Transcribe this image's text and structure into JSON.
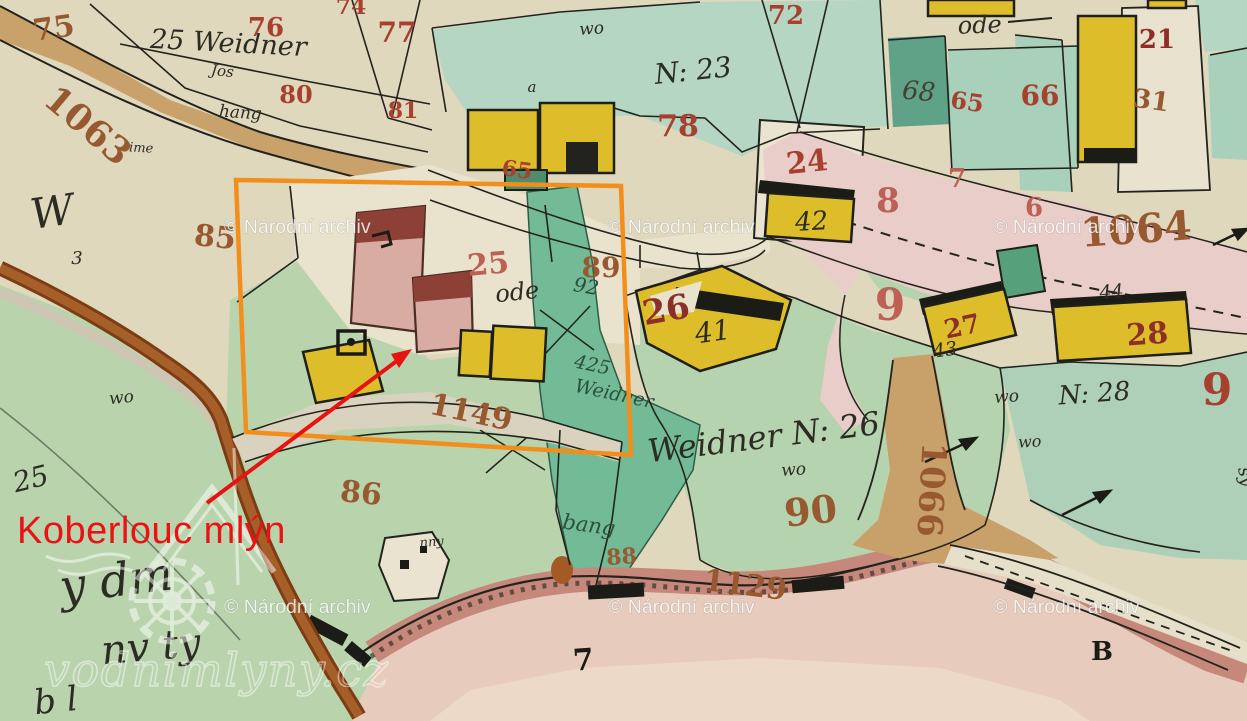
{
  "annotation": {
    "label": "Koberlouc mlýn",
    "label_color": "#ea1313",
    "arrow_color": "#e81212",
    "box_color": "#f28e1c"
  },
  "watermarks": {
    "archive_text": "© Národní archiv",
    "archive_color": "rgba(255,255,255,0.8)",
    "positions": [
      {
        "x": 224,
        "y": 233
      },
      {
        "x": 608,
        "y": 233
      },
      {
        "x": 993,
        "y": 233
      },
      {
        "x": 224,
        "y": 613
      },
      {
        "x": 608,
        "y": 613
      },
      {
        "x": 993,
        "y": 613
      }
    ],
    "site_text": "vodnimlyny.cz"
  },
  "palette": {
    "red": "#a8402f",
    "pinkRed": "#bd6055",
    "darkRed": "#8c2f28",
    "brown": "#975930",
    "teal": "#2d4f3e",
    "black": "#2c2c24",
    "dark": "#45402f",
    "blackBold": "#1c1c16"
  },
  "map_labels": {
    "items": [
      {
        "t": "75",
        "x": 55,
        "y": 38,
        "s": 30,
        "c": "brown",
        "r": -8,
        "f": "num"
      },
      {
        "t": "25 Weidner",
        "x": 228,
        "y": 52,
        "s": 27,
        "c": "black",
        "r": 3,
        "f": "script"
      },
      {
        "t": "Jos",
        "x": 222,
        "y": 76,
        "s": 15,
        "c": "black",
        "r": 6,
        "f": "script"
      },
      {
        "t": "hang",
        "x": 240,
        "y": 118,
        "s": 17,
        "c": "black",
        "r": 4,
        "f": "script"
      },
      {
        "t": "ime",
        "x": 141,
        "y": 152,
        "s": 13,
        "c": "black",
        "r": 3,
        "f": "script"
      },
      {
        "t": "1063",
        "x": 80,
        "y": 135,
        "s": 36,
        "c": "brown",
        "r": 40,
        "f": "num"
      },
      {
        "t": "76",
        "x": 266,
        "y": 36,
        "s": 26,
        "c": "red",
        "r": 0,
        "f": "num"
      },
      {
        "t": "74",
        "x": 351,
        "y": 14,
        "s": 22,
        "c": "red",
        "r": 0,
        "f": "num"
      },
      {
        "t": "77",
        "x": 397,
        "y": 42,
        "s": 28,
        "c": "red",
        "r": 0,
        "f": "num"
      },
      {
        "t": "80",
        "x": 296,
        "y": 103,
        "s": 24,
        "c": "red",
        "r": 0,
        "f": "num"
      },
      {
        "t": "81",
        "x": 403,
        "y": 118,
        "s": 22,
        "c": "red",
        "r": 0,
        "f": "num"
      },
      {
        "t": "wo",
        "x": 592,
        "y": 34,
        "s": 17,
        "c": "black",
        "r": -4,
        "f": "script"
      },
      {
        "t": "a",
        "x": 532,
        "y": 92,
        "s": 15,
        "c": "black",
        "r": 0,
        "f": "script"
      },
      {
        "t": "N: 23",
        "x": 694,
        "y": 80,
        "s": 28,
        "c": "black",
        "r": -6,
        "f": "script"
      },
      {
        "t": "72",
        "x": 786,
        "y": 24,
        "s": 26,
        "c": "red",
        "r": 0,
        "f": "num"
      },
      {
        "t": "78",
        "x": 678,
        "y": 136,
        "s": 30,
        "c": "red",
        "r": 0,
        "f": "num"
      },
      {
        "t": "ode",
        "x": 980,
        "y": 33,
        "s": 24,
        "c": "black",
        "r": -2,
        "f": "script"
      },
      {
        "t": "68",
        "x": 918,
        "y": 100,
        "s": 26,
        "c": "dark",
        "r": 5,
        "f": "script"
      },
      {
        "t": "65",
        "x": 966,
        "y": 110,
        "s": 24,
        "c": "red",
        "r": 8,
        "f": "num"
      },
      {
        "t": "66",
        "x": 1040,
        "y": 105,
        "s": 28,
        "c": "red",
        "r": 0,
        "f": "num"
      },
      {
        "t": "21",
        "x": 1157,
        "y": 48,
        "s": 26,
        "c": "darkRed",
        "r": 0,
        "f": "num"
      },
      {
        "t": "31",
        "x": 1150,
        "y": 109,
        "s": 26,
        "c": "brown",
        "r": 8,
        "f": "num"
      },
      {
        "t": "24",
        "x": 808,
        "y": 172,
        "s": 30,
        "c": "red",
        "r": -6,
        "f": "num"
      },
      {
        "t": "42",
        "x": 812,
        "y": 230,
        "s": 26,
        "c": "black",
        "r": -3,
        "f": "script"
      },
      {
        "t": "65",
        "x": 516,
        "y": 177,
        "s": 22,
        "c": "red",
        "r": 8,
        "f": "num"
      },
      {
        "t": "25",
        "x": 489,
        "y": 274,
        "s": 30,
        "c": "pinkRed",
        "r": -5,
        "f": "num"
      },
      {
        "t": "ode",
        "x": 518,
        "y": 300,
        "s": 24,
        "c": "black",
        "r": -6,
        "f": "script"
      },
      {
        "t": "89",
        "x": 601,
        "y": 277,
        "s": 28,
        "c": "brown",
        "r": 0,
        "f": "num"
      },
      {
        "t": "8",
        "x": 888,
        "y": 212,
        "s": 34,
        "c": "pinkRed",
        "r": 0,
        "f": "num"
      },
      {
        "t": "7",
        "x": 957,
        "y": 187,
        "s": 26,
        "c": "pinkRed",
        "r": 0,
        "f": "num"
      },
      {
        "t": "6",
        "x": 1034,
        "y": 216,
        "s": 26,
        "c": "pinkRed",
        "r": 0,
        "f": "num"
      },
      {
        "t": "1064",
        "x": 1137,
        "y": 243,
        "s": 40,
        "c": "brown",
        "r": -4,
        "f": "num"
      },
      {
        "t": "9",
        "x": 890,
        "y": 320,
        "s": 44,
        "c": "pinkRed",
        "r": 0,
        "f": "num"
      },
      {
        "t": "W",
        "x": 54,
        "y": 226,
        "s": 42,
        "c": "black",
        "r": -8,
        "f": "script"
      },
      {
        "t": "3",
        "x": 77,
        "y": 264,
        "s": 18,
        "c": "black",
        "r": 0,
        "f": "script"
      },
      {
        "t": "85",
        "x": 214,
        "y": 247,
        "s": 30,
        "c": "brown",
        "r": 6,
        "f": "num"
      },
      {
        "t": "26",
        "x": 668,
        "y": 321,
        "s": 34,
        "c": "darkRed",
        "r": -10,
        "f": "num"
      },
      {
        "t": "41",
        "x": 714,
        "y": 341,
        "s": 28,
        "c": "black",
        "r": -8,
        "f": "script"
      },
      {
        "t": "Weidner N: 26",
        "x": 765,
        "y": 448,
        "s": 32,
        "c": "black",
        "r": -7,
        "f": "script"
      },
      {
        "t": "wo",
        "x": 794,
        "y": 475,
        "s": 17,
        "c": "black",
        "r": -4,
        "f": "script"
      },
      {
        "t": "27",
        "x": 964,
        "y": 335,
        "s": 26,
        "c": "darkRed",
        "r": -12,
        "f": "num"
      },
      {
        "t": "43",
        "x": 946,
        "y": 356,
        "s": 19,
        "c": "black",
        "r": -8,
        "f": "script"
      },
      {
        "t": "44",
        "x": 1112,
        "y": 298,
        "s": 19,
        "c": "black",
        "r": -5,
        "f": "script"
      },
      {
        "t": "28",
        "x": 1148,
        "y": 344,
        "s": 30,
        "c": "darkRed",
        "r": -4,
        "f": "num"
      },
      {
        "t": "wo",
        "x": 1007,
        "y": 402,
        "s": 17,
        "c": "black",
        "r": -4,
        "f": "script"
      },
      {
        "t": "N: 28",
        "x": 1095,
        "y": 402,
        "s": 26,
        "c": "black",
        "r": -4,
        "f": "script"
      },
      {
        "t": "9",
        "x": 1217,
        "y": 405,
        "s": 44,
        "c": "red",
        "r": 0,
        "f": "num"
      },
      {
        "t": "wo",
        "x": 1030,
        "y": 447,
        "s": 16,
        "c": "black",
        "r": -3,
        "f": "script"
      },
      {
        "t": "92",
        "x": 585,
        "y": 293,
        "s": 20,
        "c": "teal",
        "r": 10,
        "f": "script"
      },
      {
        "t": "425",
        "x": 591,
        "y": 371,
        "s": 19,
        "c": "teal",
        "r": 12,
        "f": "script"
      },
      {
        "t": "Weidner",
        "x": 613,
        "y": 400,
        "s": 19,
        "c": "teal",
        "r": 12,
        "f": "script"
      },
      {
        "t": "bang",
        "x": 588,
        "y": 532,
        "s": 21,
        "c": "teal",
        "r": 8,
        "f": "script"
      },
      {
        "t": "88",
        "x": 622,
        "y": 564,
        "s": 22,
        "c": "brown",
        "r": -4,
        "f": "num"
      },
      {
        "t": "1129",
        "x": 744,
        "y": 595,
        "s": 30,
        "c": "brown",
        "r": 7,
        "f": "num"
      },
      {
        "t": "90",
        "x": 812,
        "y": 524,
        "s": 38,
        "c": "brown",
        "r": -6,
        "f": "num"
      },
      {
        "t": "1066",
        "x": 920,
        "y": 489,
        "s": 34,
        "c": "brown",
        "r": 93,
        "f": "num"
      },
      {
        "t": "86",
        "x": 360,
        "y": 503,
        "s": 30,
        "c": "brown",
        "r": 6,
        "f": "num"
      },
      {
        "t": "1149",
        "x": 469,
        "y": 422,
        "s": 30,
        "c": "brown",
        "r": 12,
        "f": "num"
      },
      {
        "t": "wo",
        "x": 122,
        "y": 403,
        "s": 17,
        "c": "black",
        "r": -6,
        "f": "script"
      },
      {
        "t": "25",
        "x": 33,
        "y": 488,
        "s": 28,
        "c": "black",
        "r": -14,
        "f": "script"
      },
      {
        "t": "y dm",
        "x": 118,
        "y": 596,
        "s": 46,
        "c": "black",
        "r": -7,
        "f": "script"
      },
      {
        "t": "nv ty",
        "x": 152,
        "y": 660,
        "s": 40,
        "c": "black",
        "r": -5,
        "f": "script"
      },
      {
        "t": "b l",
        "x": 57,
        "y": 712,
        "s": 34,
        "c": "black",
        "r": -6,
        "f": "script"
      },
      {
        "t": "nny",
        "x": 432,
        "y": 546,
        "s": 13,
        "c": "black",
        "r": -5,
        "f": "script"
      },
      {
        "t": "7",
        "x": 584,
        "y": 670,
        "s": 30,
        "c": "blackBold",
        "r": -4,
        "f": "bold"
      },
      {
        "t": "B",
        "x": 1102,
        "y": 660,
        "s": 26,
        "c": "blackBold",
        "r": 0,
        "f": "bold"
      },
      {
        "t": "sy",
        "x": 1240,
        "y": 478,
        "s": 18,
        "c": "black",
        "r": 78,
        "f": "script"
      }
    ]
  }
}
